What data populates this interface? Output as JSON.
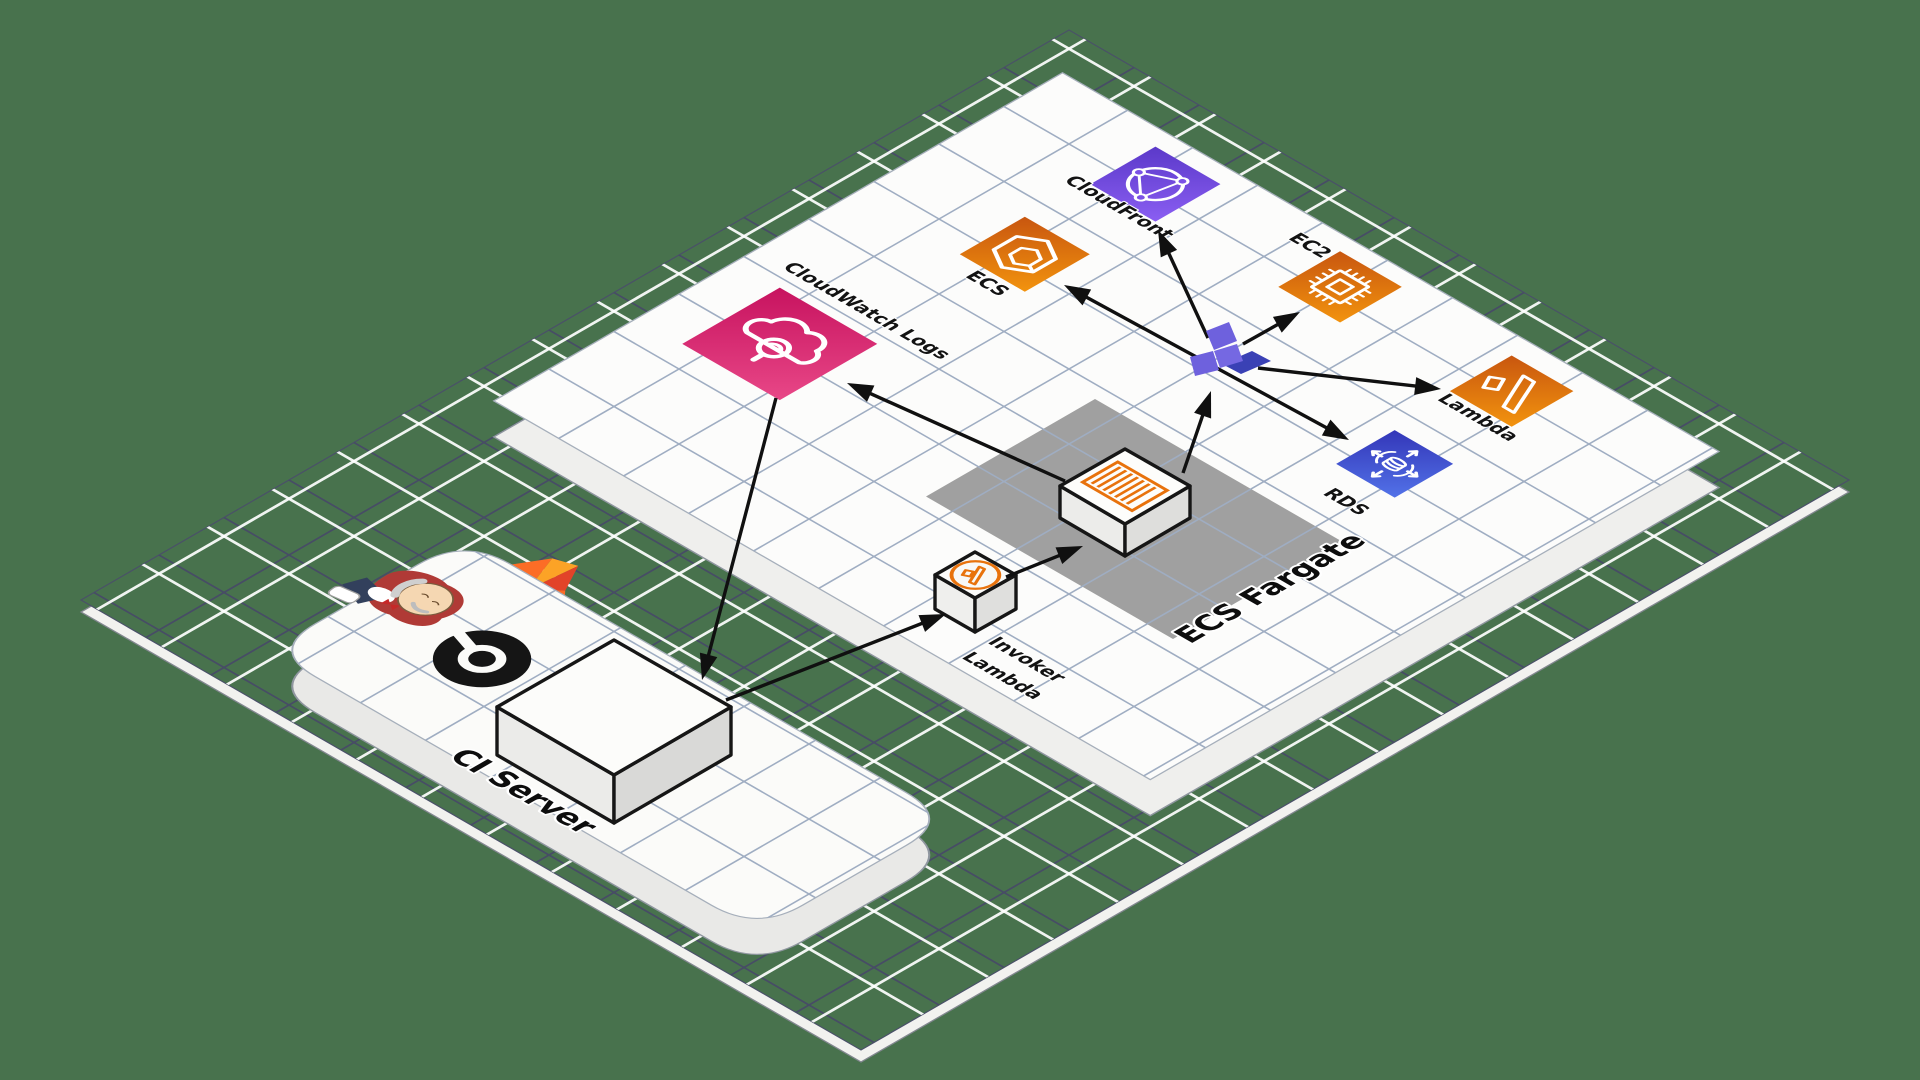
{
  "diagram": {
    "background_color": "#48724d",
    "floor": {
      "grid_navy": "#474c66",
      "grid_white": "#ffffff",
      "plate_grid": "#9fadc2"
    },
    "platforms": {
      "ci_server": {
        "label": "CI Server"
      },
      "ecs_fargate": {
        "label": "ECS Fargate",
        "zone_color": "#a0a0a0"
      }
    },
    "nodes": {
      "cloudwatch_logs": {
        "label": "CloudWatch Logs",
        "icon": "cloudwatch-logs-icon",
        "color": "#d62e6e"
      },
      "cloudfront": {
        "label": "CloudFront",
        "icon": "cloudfront-icon",
        "color": "#7b52e6"
      },
      "ecs": {
        "label": "ECS",
        "icon": "ecs-icon",
        "color": "#e07813"
      },
      "ec2": {
        "label": "EC2",
        "icon": "ec2-icon",
        "color": "#e07813"
      },
      "lambda": {
        "label": "Lambda",
        "icon": "lambda-icon",
        "color": "#e07813"
      },
      "rds": {
        "label": "RDS",
        "icon": "rds-icon",
        "color": "#3c4fd0"
      },
      "invoker_lambda": {
        "label_lines": [
          "Invoker",
          "Lambda"
        ],
        "icon": "lambda-cube-icon",
        "accent": "#e8720c"
      },
      "fargate_task": {
        "icon": "container-task-icon",
        "accent": "#e8720c"
      },
      "ci_build_box": {
        "icon": "build-server-box"
      },
      "deploy_marker": {
        "icon": "purple-x-marker",
        "light": "#6e61dd",
        "dark": "#3a41b5"
      }
    },
    "logos": [
      {
        "name": "jenkins-logo"
      },
      {
        "name": "gitlab-logo",
        "colors": [
          "#fc6d26",
          "#fca326",
          "#e24329"
        ]
      },
      {
        "name": "circleci-logo",
        "color": "#151515"
      }
    ],
    "edges": [
      {
        "from": "cloudwatch_logs",
        "to": "ci_build_box",
        "heads": "end"
      },
      {
        "from": "ci_build_box",
        "to": "invoker_lambda",
        "heads": "end"
      },
      {
        "from": "invoker_lambda",
        "to": "fargate_task",
        "heads": "end"
      },
      {
        "from": "fargate_task",
        "to": "deploy_marker",
        "heads": "end"
      },
      {
        "from": "fargate_task",
        "to": "cloudwatch_logs",
        "heads": "end"
      },
      {
        "from": "ecs",
        "to": "rds",
        "heads": "both"
      },
      {
        "from": "deploy_marker",
        "to": "cloudfront",
        "heads": "end"
      },
      {
        "from": "deploy_marker",
        "to": "ec2",
        "heads": "end"
      },
      {
        "from": "deploy_marker",
        "to": "lambda",
        "heads": "end"
      }
    ]
  }
}
